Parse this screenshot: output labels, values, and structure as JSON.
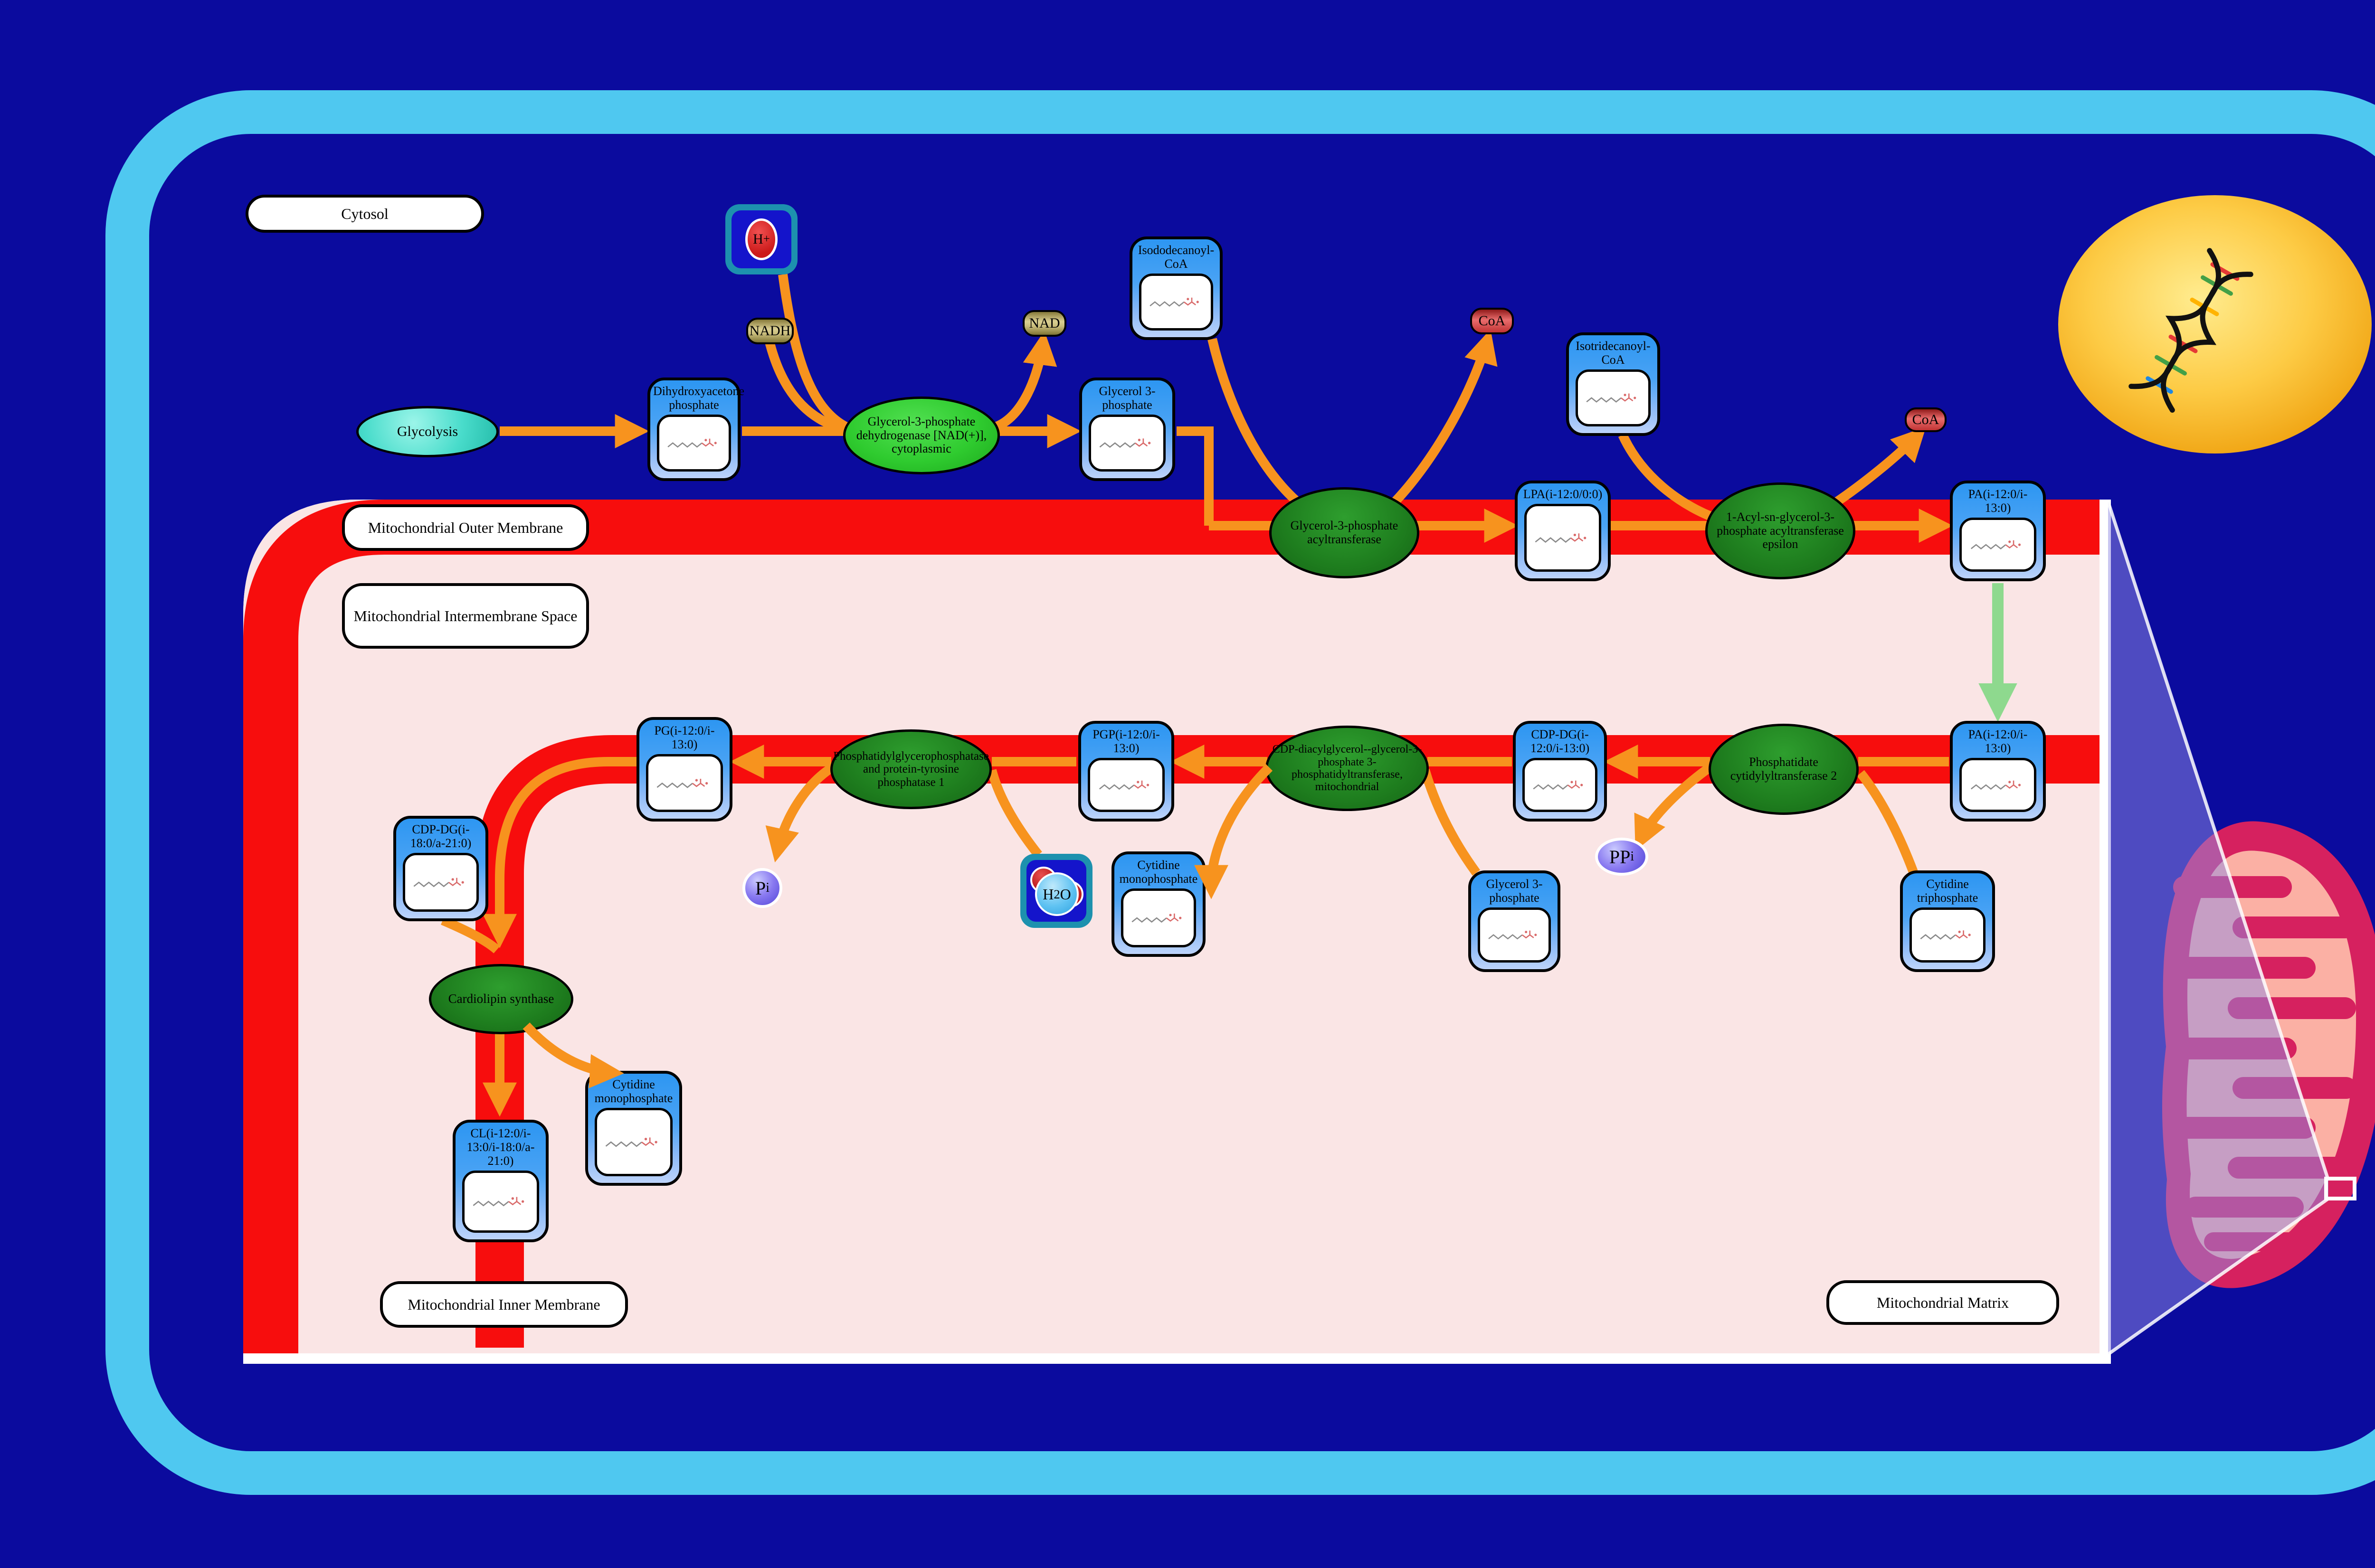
{
  "colors": {
    "background": "#0B0B9E",
    "cell_border": "#4FC8F0",
    "membrane_red": "#F70D0D",
    "intermembrane_fill": "#FAE5E5",
    "flow_arrow_orange": "#F7931E",
    "transport_arrow_green": "#8ED98E",
    "enzyme_green": "#1E7D1E",
    "enzyme_bright_green": "#2FCB2F",
    "node_header_blue": "#2D96F2",
    "nucleus_yellow": "#FDCB45",
    "mitochondrion_pink": "#D6215F",
    "mitochondrion_matrix": "#FBB0A4"
  },
  "compartment_labels": [
    {
      "id": "cytosol",
      "label": "Cytosol",
      "box": [
        517,
        410,
        502,
        80
      ]
    },
    {
      "id": "outer-membrane",
      "label": "Mitochondrial Outer Membrane",
      "box": [
        720,
        1062,
        520,
        98
      ]
    },
    {
      "id": "intermembrane-space",
      "label": "Mitochondrial Intermembrane Space",
      "box": [
        720,
        1228,
        520,
        138
      ]
    },
    {
      "id": "inner-membrane",
      "label": "Mitochondrial Inner Membrane",
      "box": [
        800,
        2698,
        522,
        98
      ]
    },
    {
      "id": "matrix",
      "label": "Mitochondrial Matrix",
      "box": [
        3845,
        2696,
        490,
        94
      ]
    }
  ],
  "pathway_node": {
    "id": "glycolysis",
    "label": "Glycolysis",
    "box": [
      750,
      855,
      300,
      108
    ]
  },
  "metabolites": [
    {
      "id": "dhap",
      "label": "Dihydroxyacetone phosphate",
      "box": [
        1363,
        795,
        196,
        218
      ]
    },
    {
      "id": "glycerol-3-phosphate-cytosol",
      "label": "Glycerol 3-phosphate",
      "box": [
        2272,
        795,
        202,
        218
      ]
    },
    {
      "id": "isododecanoyl-coa",
      "label": "Isododecanoyl-CoA",
      "box": [
        2378,
        498,
        196,
        218
      ]
    },
    {
      "id": "isotridecanoyl-coa",
      "label": "Isotridecanoyl-CoA",
      "box": [
        3297,
        700,
        198,
        218
      ]
    },
    {
      "id": "lpa",
      "label": "LPA(i-12:0/0:0)",
      "box": [
        3189,
        1012,
        202,
        212
      ]
    },
    {
      "id": "pa-outer",
      "label": "PA(i-12:0/i-13:0)",
      "box": [
        4105,
        1012,
        202,
        212
      ]
    },
    {
      "id": "pa-inner",
      "label": "PA(i-12:0/i-13:0)",
      "box": [
        4105,
        1518,
        202,
        212
      ]
    },
    {
      "id": "cdp-dg-1",
      "label": "CDP-DG(i-12:0/i-13:0)",
      "box": [
        3185,
        1518,
        198,
        212
      ]
    },
    {
      "id": "pgp",
      "label": "PGP(i-12:0/i-13:0)",
      "box": [
        2270,
        1518,
        202,
        212
      ]
    },
    {
      "id": "pg",
      "label": "PG(i-12:0/i-13:0)",
      "box": [
        1340,
        1510,
        202,
        220
      ]
    },
    {
      "id": "cytidine-triphosphate",
      "label": "Cytidine triphosphate",
      "box": [
        4000,
        1833,
        200,
        214
      ]
    },
    {
      "id": "glycerol-3-phosphate-ims",
      "label": "Glycerol 3-phosphate",
      "box": [
        3091,
        1833,
        194,
        214
      ]
    },
    {
      "id": "cytidine-monophosphate-1",
      "label": "Cytidine monophosphate",
      "box": [
        2340,
        1793,
        198,
        222
      ]
    },
    {
      "id": "cdp-dg-2",
      "label": "CDP-DG(i-18:0/a-21:0)",
      "box": [
        828,
        1718,
        200,
        222
      ]
    },
    {
      "id": "cytidine-monophosphate-2",
      "label": "Cytidine monophosphate",
      "box": [
        1232,
        2255,
        204,
        242
      ]
    },
    {
      "id": "cardiolipin",
      "label": "CL(i-12:0/i-13:0/i-18:0/a-21:0)",
      "box": [
        953,
        2358,
        202,
        258
      ]
    }
  ],
  "enzymes": [
    {
      "id": "gpd-cytoplasmic",
      "label": "Glycerol-3-phosphate dehydrogenase [NAD(+)], cytoplasmic",
      "ellipse": [
        1940,
        917,
        165,
        82
      ],
      "font": 26,
      "style": "bright"
    },
    {
      "id": "gpat",
      "label": "Glycerol-3-phosphate acyltransferase",
      "ellipse": [
        2830,
        1122,
        158,
        96
      ],
      "font": 26,
      "style": "dark"
    },
    {
      "id": "agpat-epsilon",
      "label": "1-Acyl-sn-glycerol-3-phosphate acyltransferase epsilon",
      "ellipse": [
        3748,
        1118,
        158,
        102
      ],
      "font": 26,
      "style": "dark"
    },
    {
      "id": "phosphatidate-cytidylyltransferase-2",
      "label": "Phosphatidate cytidylyltransferase 2",
      "ellipse": [
        3755,
        1620,
        158,
        96
      ],
      "font": 26,
      "style": "dark"
    },
    {
      "id": "cdp-dag-g3p-phosphatidyltransferase",
      "label": "CDP-diacylglycerol--glycerol-3-phosphate 3-phosphatidyltransferase, mitochondrial",
      "ellipse": [
        2836,
        1618,
        172,
        90
      ],
      "font": 24,
      "style": "dark"
    },
    {
      "id": "pgp-phosphatase",
      "label": "Phosphatidylglycerophosphatase and protein-tyrosine phosphatase 1",
      "ellipse": [
        1918,
        1620,
        170,
        84
      ],
      "font": 25,
      "style": "dark"
    },
    {
      "id": "cardiolipin-synthase",
      "label": "Cardiolipin synthase",
      "ellipse": [
        1055,
        2104,
        152,
        74
      ],
      "font": 27,
      "style": "dark"
    }
  ],
  "cofactors": [
    {
      "id": "nadh",
      "type": "khaki",
      "main": "NADH",
      "box": [
        1571,
        669,
        100,
        56
      ]
    },
    {
      "id": "nad",
      "type": "khaki",
      "main": "NAD",
      "box": [
        2153,
        653,
        92,
        56
      ]
    },
    {
      "id": "coa-1",
      "type": "red",
      "main": "CoA",
      "box": [
        3095,
        648,
        92,
        56
      ]
    },
    {
      "id": "coa-2",
      "type": "red",
      "main": "CoA",
      "box": [
        4010,
        858,
        88,
        52
      ]
    },
    {
      "id": "pi",
      "type": "purple",
      "main": "P",
      "sub": "i",
      "box": [
        1563,
        1828,
        84,
        84
      ]
    },
    {
      "id": "ppi",
      "type": "purple",
      "main": "PP",
      "sub": "i",
      "box": [
        3358,
        1764,
        112,
        80
      ]
    },
    {
      "id": "proton",
      "type": "ion",
      "main": "H",
      "sup": "+",
      "box": [
        1527,
        430,
        152,
        148
      ]
    },
    {
      "id": "water",
      "type": "water",
      "main": "H",
      "sub": "2",
      "tail": "O",
      "box": [
        2148,
        1798,
        152,
        156
      ]
    }
  ]
}
